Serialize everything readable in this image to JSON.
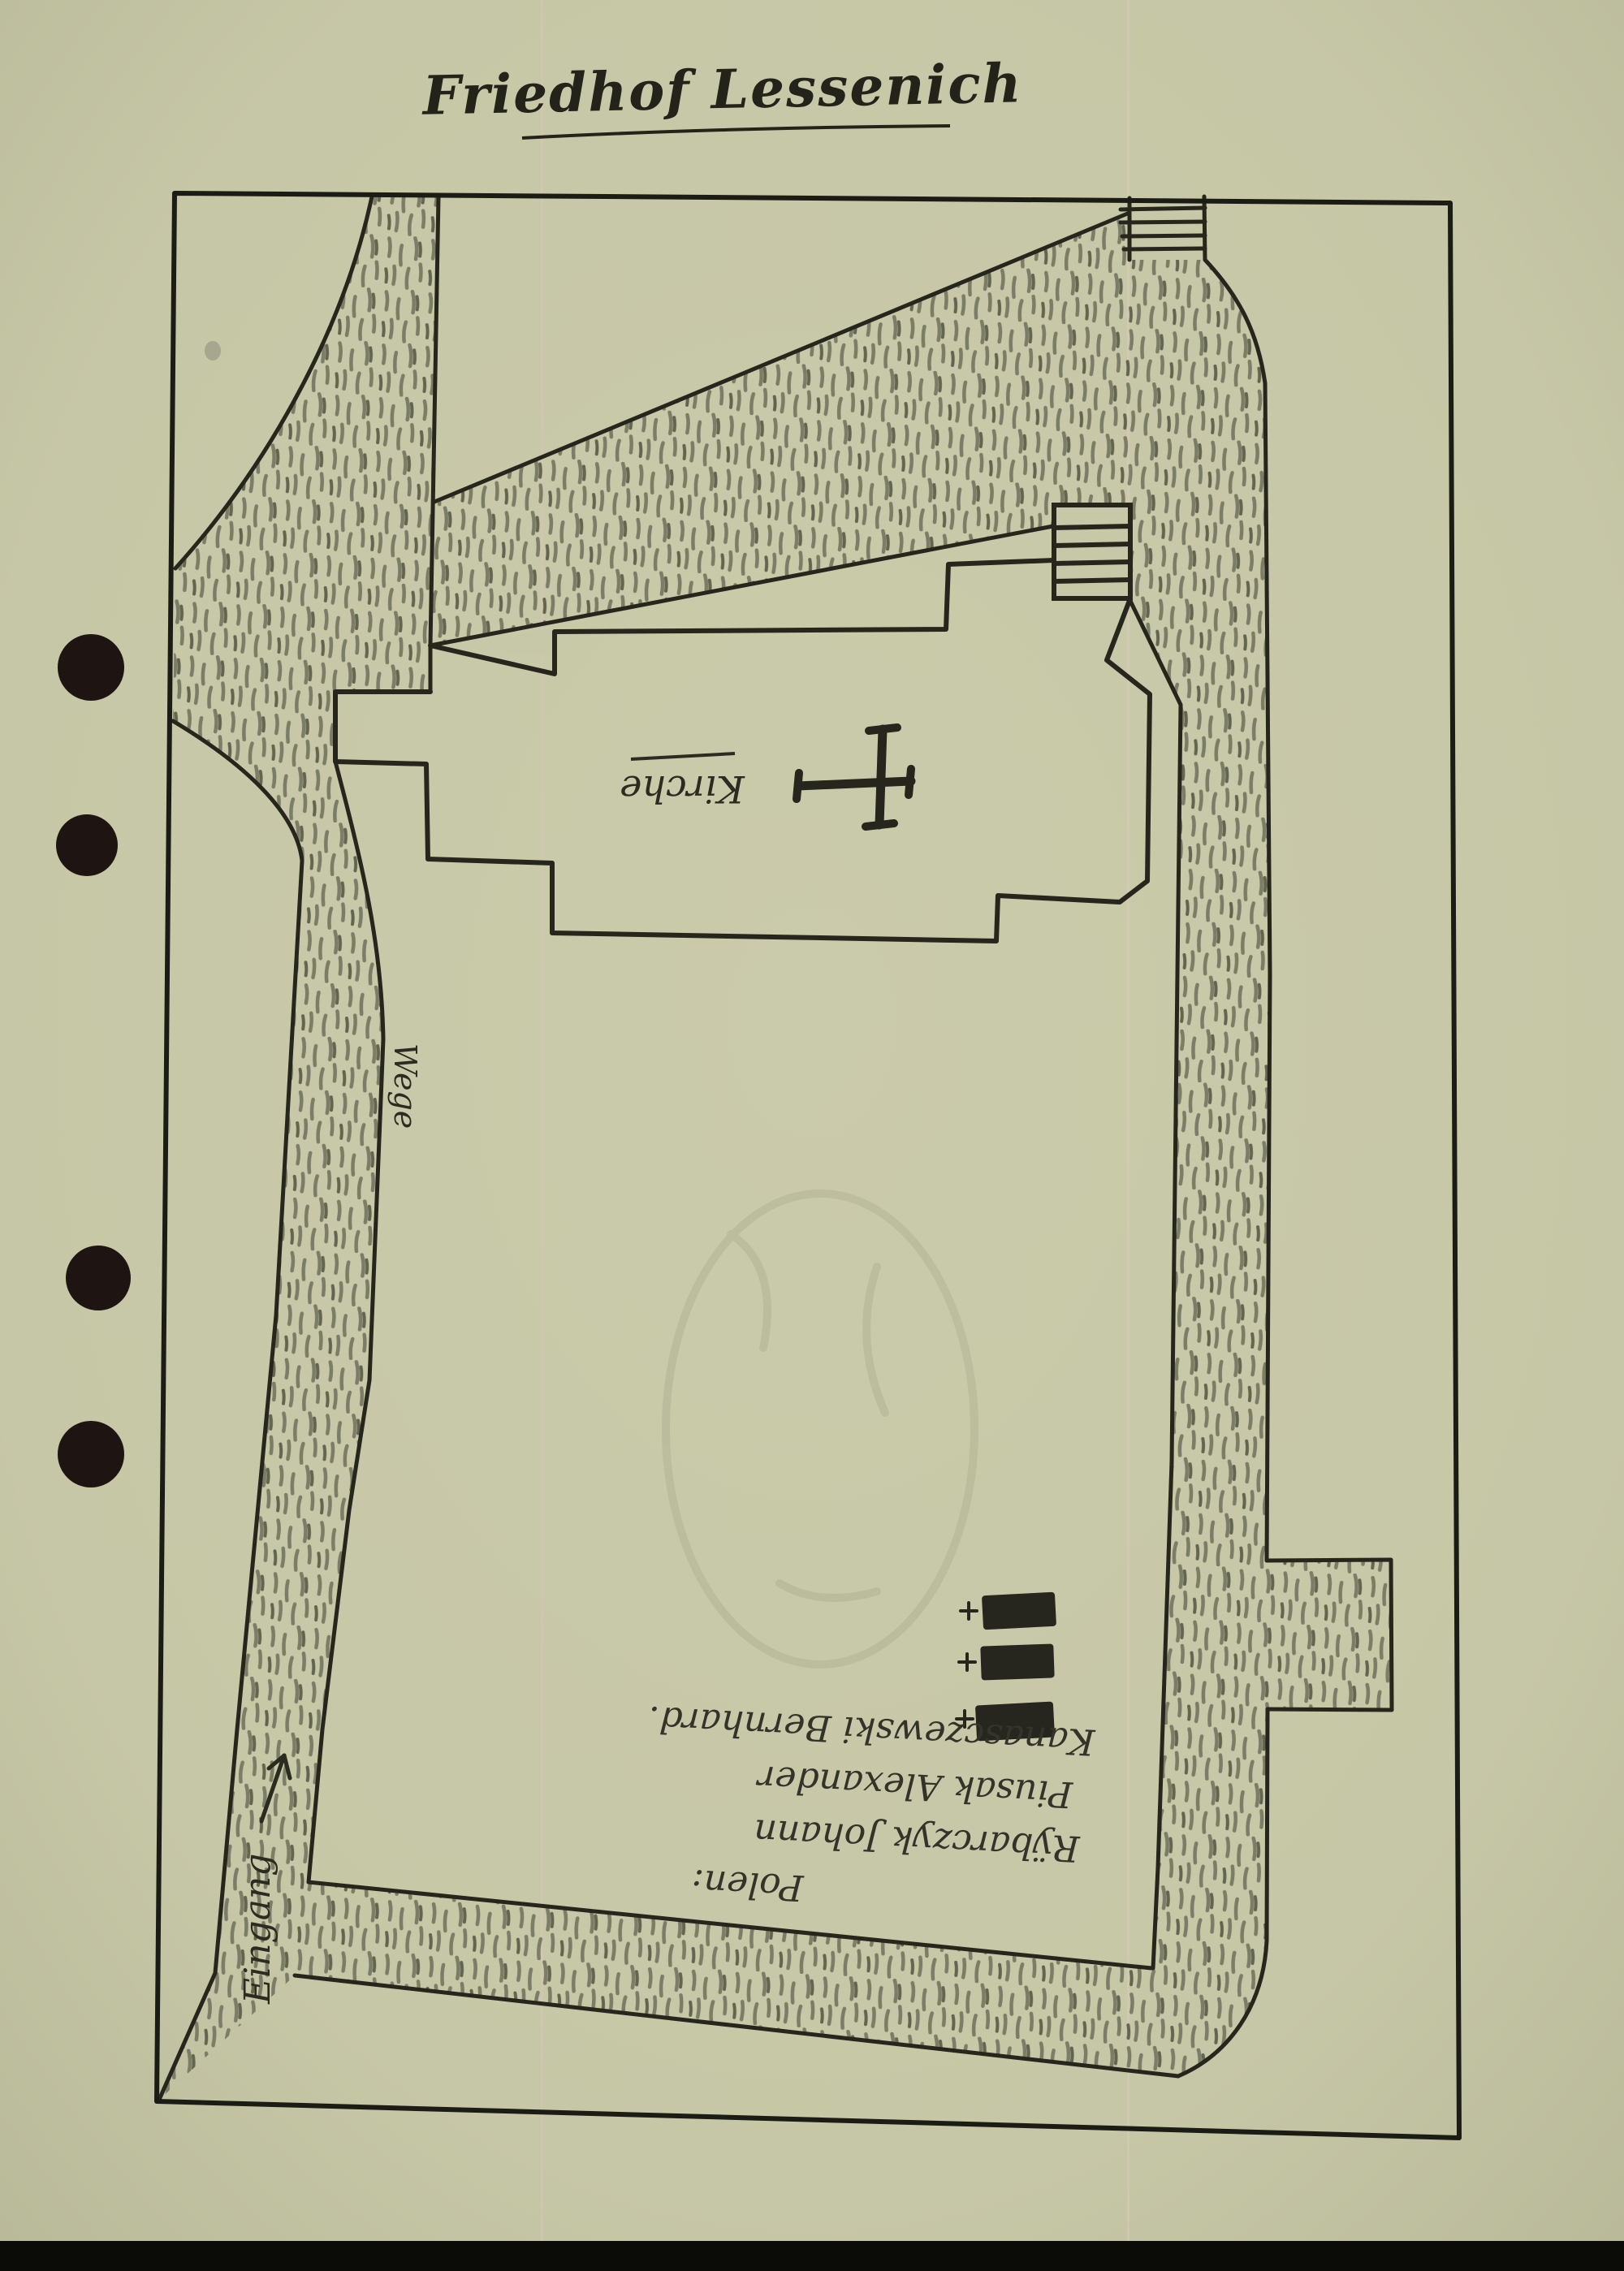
{
  "document": {
    "title": "Friedhof Lessenich"
  },
  "map": {
    "church_label": "Kirche",
    "path_label": "Wege",
    "entrance_label": "Eingang",
    "memo": {
      "heading": "Polen:",
      "line1": "Rÿbarczyk Johann",
      "line2": "Piusak Alexander",
      "line3": "Kanasczewski Bernhard."
    },
    "grave_cross_symbol": "+",
    "graves_count": 3,
    "hole_punches_count": 4,
    "stair_flights_count": 2
  },
  "colors": {
    "paper": "#c7c8a7",
    "ink": "#26261d",
    "pencil_hatch": "#7b7d66",
    "hole_punch": "#1e1411",
    "grave_fill": "#26261e",
    "scan_band": "#0b0b08"
  }
}
